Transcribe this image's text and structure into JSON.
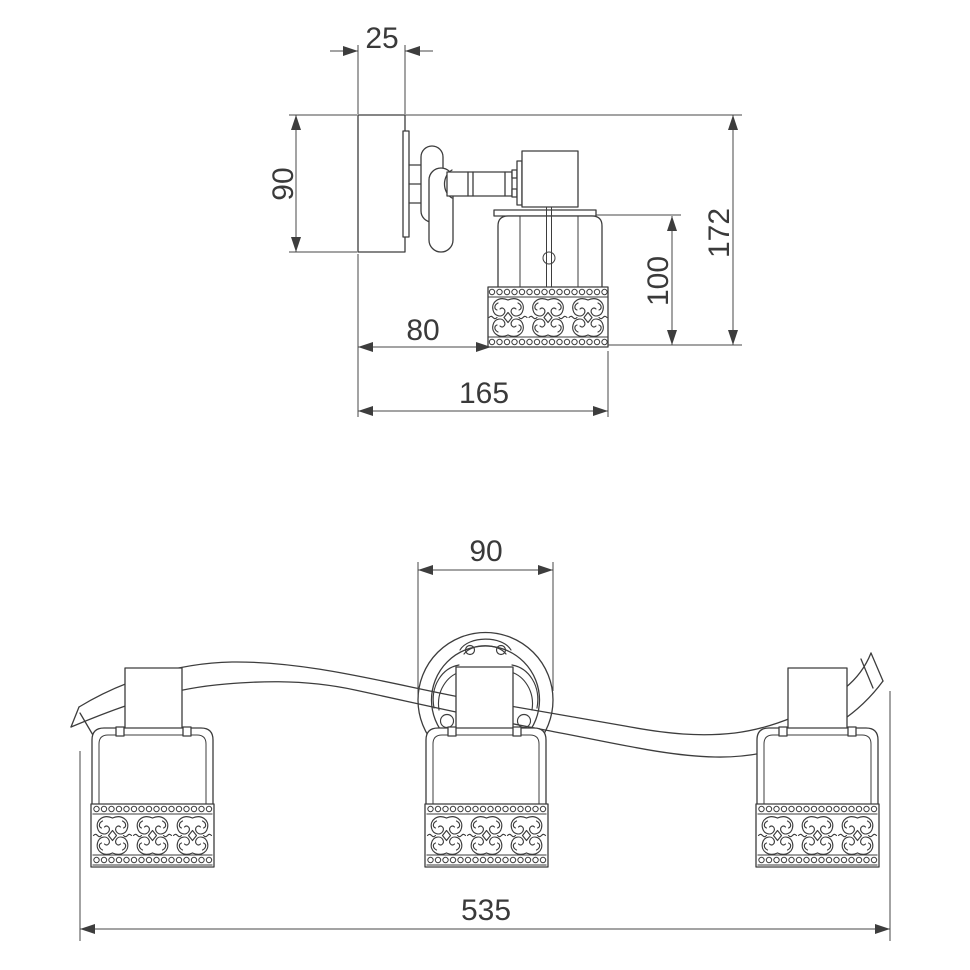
{
  "drawing": {
    "side_view": {
      "dimensions": {
        "bracket_depth": "25",
        "bracket_height": "90",
        "wall_to_shade": "80",
        "total_projection": "165",
        "shade_height": "100",
        "total_height": "172"
      }
    },
    "front_view": {
      "dimensions": {
        "medallion_diameter": "90",
        "total_width": "535"
      }
    }
  }
}
